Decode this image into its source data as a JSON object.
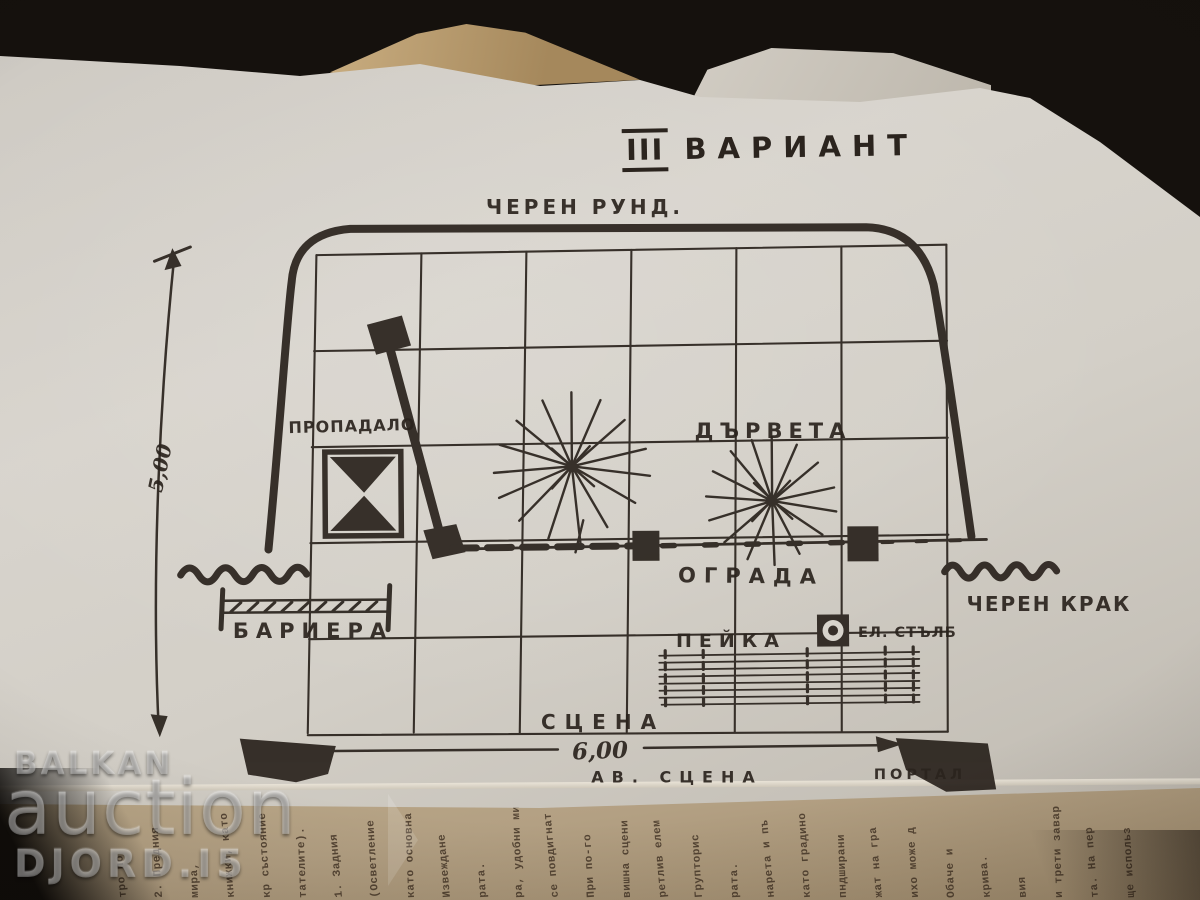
{
  "diagram": {
    "title_numeral": "III",
    "title": "ВАРИАНТ",
    "labels": {
      "backdrop_top": "ЧЕРЕН РУНД.",
      "trapdoor": "ПРОПАДАЛО",
      "trees": "ДЪРВЕТА",
      "fence": "ОГРАДА",
      "barrier": "БАРИЕРА",
      "black_leg": "ЧЕРЕН КРАК",
      "bench": "ПЕЙКА",
      "electric_pole": "ЕЛ. СТЪЛБ",
      "stage": "СЦЕНА",
      "apron_stage": "АВ. СЦЕНА",
      "portal": "ПОРТАЛ"
    },
    "dimensions": {
      "width": "6,00",
      "height": "5,00"
    },
    "grid": {
      "cols": 6,
      "rows": 5
    },
    "ink_color": "#2b241e"
  },
  "watermark": {
    "line1": "BALKAN",
    "line2": "auction",
    "line3": "DJORD.I5"
  },
  "bottom_page": {
    "fragments": [
      "тро по",
      "2. Предния",
      "мира,",
      "книжки, като",
      "кр състояние",
      "тателите).",
      "1. Задния",
      "(Осветление",
      "като основна",
      "Извеждане",
      "рата.",
      "ра, удобни ми",
      "се повдигнат",
      "При по-го",
      "вишна сцени",
      "ретлив елем",
      "Групторис",
      "рата.",
      "нарета и пъ",
      "като градино",
      "пндширани",
      "жат на гра",
      "ихо може д",
      "Обаче и",
      "крива.",
      "вия",
      "и трети завар",
      "та. На пер",
      "ще использ"
    ]
  }
}
